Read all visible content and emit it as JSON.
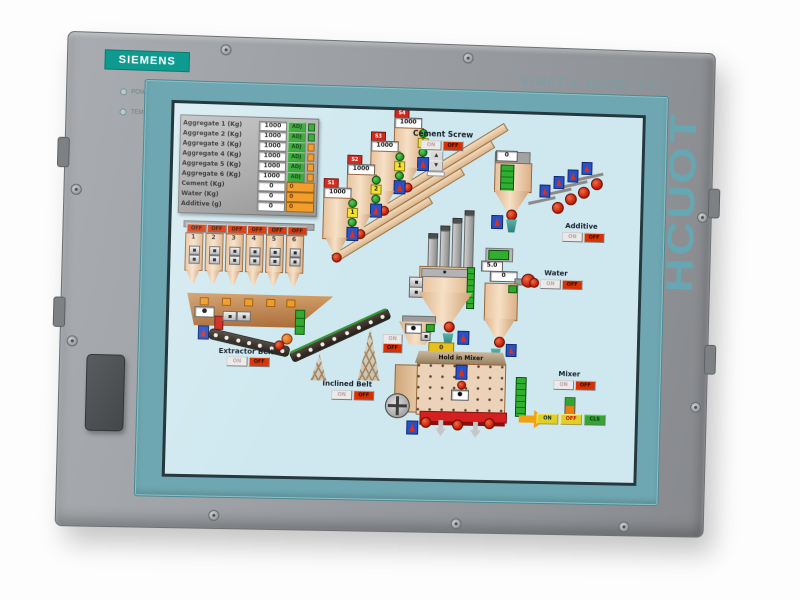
{
  "device": {
    "brand": "SIEMENS",
    "model": "SIMATIC PANEL PC",
    "badge": "TOUCH",
    "leds": [
      {
        "label": "POWER"
      },
      {
        "label": "TEMP"
      }
    ]
  },
  "colors": {
    "brand_teal": "#0f9a90",
    "bezel_teal": "#6ea7b1",
    "frame_grey": "#9a9da1",
    "screen_bg": "#cfe8ef",
    "alarm_red": "#d83000",
    "run_green": "#2fa62f",
    "warn_orange": "#f09820",
    "equipment_tan": "#ecd0b0"
  },
  "hmi": {
    "batch_table": {
      "rows": [
        {
          "label": "Aggregate 1 (Kg)",
          "value": "1000",
          "adj": "ADJ"
        },
        {
          "label": "Aggregate 2 (Kg)",
          "value": "1000",
          "adj": "ADJ"
        },
        {
          "label": "Aggregate 3 (Kg)",
          "value": "1000",
          "adj": "ADJ"
        },
        {
          "label": "Aggregate 4 (Kg)",
          "value": "1000",
          "adj": "ADJ"
        },
        {
          "label": "Aggregate 5 (Kg)",
          "value": "1000",
          "adj": "ADJ"
        },
        {
          "label": "Aggregate 6 (Kg)",
          "value": "1000",
          "adj": "ADJ"
        },
        {
          "label": "Cement (Kg)",
          "value": "0",
          "amount": "0"
        },
        {
          "label": "Water (Kg)",
          "value": "0",
          "amount": "0"
        },
        {
          "label": "Additive (g)",
          "value": "0",
          "amount": "0"
        }
      ]
    },
    "bins": {
      "off": "OFF",
      "numbers": [
        "1",
        "2",
        "3",
        "4",
        "5",
        "6"
      ]
    },
    "silos": [
      {
        "id": "S1",
        "value": "1000",
        "count": "1"
      },
      {
        "id": "S2",
        "value": "1000",
        "count": "2"
      },
      {
        "id": "S3",
        "value": "1000",
        "count": "1"
      },
      {
        "id": "S4",
        "value": "1000",
        "count": "1"
      }
    ],
    "cement_screw": {
      "label": "Cement Screw",
      "on": "ON",
      "off": "OFF",
      "up": "▲",
      "down": "▼"
    },
    "cement_silo": {
      "value": "0"
    },
    "additive": {
      "label": "Additive",
      "on": "ON",
      "off": "OFF"
    },
    "water": {
      "label": "Water",
      "on": "ON",
      "off": "OFF",
      "level": "5.0",
      "value": "0"
    },
    "extractor_belt": {
      "label": "Extractor Belt",
      "on": "ON",
      "off": "OFF"
    },
    "inclined_belt": {
      "label": "Inclined Belt",
      "on": "ON",
      "off": "OFF"
    },
    "holding_hopper": {
      "on": "ON",
      "off": "OFF"
    },
    "mixer": {
      "title": "Hold in Mixer",
      "value": "0",
      "label": "Mixer",
      "on": "ON",
      "off": "OFF",
      "commands": [
        "ON",
        "OFF",
        "CLS"
      ]
    }
  }
}
